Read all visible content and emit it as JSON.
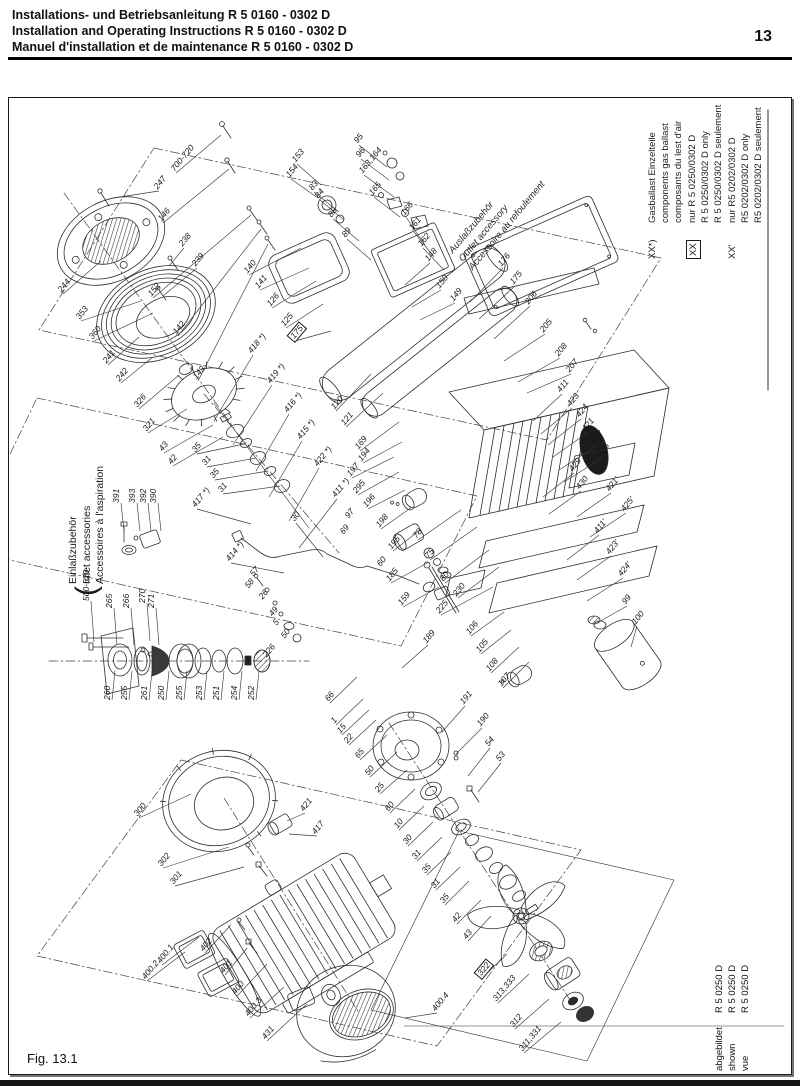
{
  "header": {
    "line1": "Installations- und Betriebsanleitung R 5 0160 - 0302 D",
    "line2": "Installation and Operating Instructions R 5 0160 - 0302 D",
    "line3": "Manuel d'installation et de maintenance R 5 0160 - 0302 D",
    "page_number": "13"
  },
  "figure": {
    "caption": "Fig. 13.1"
  },
  "legend": {
    "blocks": [
      {
        "marker": "XX*)",
        "boxed": false,
        "lines": [
          "Gasballast Einzelteile",
          "components gas ballast",
          "composants du lest d'air"
        ]
      },
      {
        "marker": "XX",
        "boxed": true,
        "lines": [
          "nur R 5 0250/0302 D",
          "R 5 0250/0302 D only",
          "R 5 0250/0302 D  seulement"
        ]
      },
      {
        "marker": "XX'",
        "boxed": false,
        "lines": [
          "nur R5 0202/0302 D",
          "R5 0202/0302 D only",
          "R5 0202/0302 D seulement"
        ]
      }
    ]
  },
  "inlet_label": {
    "bracket": "(",
    "lines": [
      "Einlaßzubehör",
      "Inlet accessories",
      "Accessoires à l'aspiration"
    ]
  },
  "outlet_label": {
    "lines": [
      "Auslaßzubehör",
      "Outlet accessory",
      "Accessoire au refoulement"
    ]
  },
  "shown": {
    "rows": [
      [
        "abgebildet",
        "R 5 0250 D"
      ],
      [
        "shown",
        "R 5 0250 D"
      ],
      [
        "vue",
        "R 5 0250 D"
      ]
    ]
  },
  "colors": {
    "ink": "#1a1a1a",
    "line": "#2e2e2e"
  },
  "callouts": [
    [
      "247",
      158,
      190,
      "d",
      [
        112,
        197
      ],
      0
    ],
    [
      "244",
      62,
      293,
      "d",
      [
        100,
        260
      ],
      0
    ],
    [
      "353",
      80,
      320,
      "d",
      [
        140,
        300
      ],
      0
    ],
    [
      "360",
      93,
      340,
      "d",
      [
        152,
        312
      ],
      0
    ],
    [
      "241",
      107,
      364,
      "d",
      [
        138,
        336
      ],
      0
    ],
    [
      "242",
      120,
      382,
      "d",
      [
        152,
        356
      ],
      0
    ],
    [
      "326",
      138,
      408,
      "d",
      [
        178,
        374
      ],
      0
    ],
    [
      "238",
      183,
      247,
      "d",
      [
        168,
        265
      ],
      0
    ],
    [
      "239",
      196,
      267,
      "d",
      [
        162,
        295
      ],
      0
    ],
    [
      "321",
      147,
      432,
      "d",
      [
        186,
        408
      ],
      0
    ],
    [
      "43",
      163,
      452,
      "d",
      [
        212,
        424
      ],
      0
    ],
    [
      "42",
      172,
      465,
      "d",
      [
        222,
        436
      ],
      0
    ],
    [
      "35",
      196,
      453,
      "d",
      [
        243,
        443
      ],
      0
    ],
    [
      "31",
      206,
      466,
      "d",
      [
        255,
        457
      ],
      0
    ],
    [
      "35",
      214,
      479,
      "d",
      [
        267,
        470
      ],
      0
    ],
    [
      "31",
      222,
      493,
      "d",
      [
        279,
        485
      ],
      0
    ],
    [
      "417 *)",
      196,
      508,
      "d",
      [
        250,
        523
      ],
      0
    ],
    [
      "414 *)",
      230,
      562,
      "d",
      [
        283,
        572
      ],
      0
    ],
    [
      "418 *)",
      252,
      354,
      "d",
      [
        213,
        420
      ],
      0
    ],
    [
      "419 *)",
      271,
      384,
      "d",
      [
        232,
        444
      ],
      0
    ],
    [
      "416 *)",
      288,
      413,
      "d",
      [
        255,
        470
      ],
      0
    ],
    [
      "415 *)",
      301,
      440,
      "d",
      [
        268,
        496
      ],
      0
    ],
    [
      "422 *)",
      318,
      467,
      "d",
      [
        288,
        520
      ],
      0
    ],
    [
      "411 *)",
      336,
      498,
      "d",
      [
        298,
        547
      ],
      0
    ],
    [
      "30",
      295,
      522,
      "d",
      [
        322,
        556
      ],
      0
    ],
    [
      "126",
      271,
      307,
      "d",
      [
        315,
        280
      ],
      0
    ],
    [
      "125",
      285,
      327,
      "d",
      [
        322,
        303
      ],
      0
    ],
    [
      "175",
      294,
      340,
      "d",
      [
        330,
        330
      ],
      1
    ],
    [
      "120",
      335,
      410,
      "d",
      [
        370,
        373
      ],
      0
    ],
    [
      "121",
      345,
      426,
      "d",
      [
        382,
        392
      ],
      0
    ],
    [
      "169",
      359,
      450,
      "d",
      [
        398,
        421
      ],
      0
    ],
    [
      "194",
      362,
      462,
      "d",
      [
        401,
        441
      ],
      0
    ],
    [
      "197",
      351,
      477,
      "d",
      [
        393,
        456
      ],
      0
    ],
    [
      "295",
      357,
      494,
      "d",
      [
        398,
        471
      ],
      0
    ],
    [
      "196",
      367,
      508,
      "d",
      [
        404,
        489
      ],
      0
    ],
    [
      "198",
      380,
      528,
      "d",
      [
        411,
        506
      ],
      0
    ],
    [
      "195",
      392,
      550,
      "d",
      [
        419,
        529
      ],
      0
    ],
    [
      "185",
      390,
      582,
      "d",
      [
        428,
        561
      ],
      0
    ],
    [
      "159",
      402,
      606,
      "d",
      [
        438,
        586
      ],
      0
    ],
    [
      "97",
      349,
      519,
      "d",
      null,
      0
    ],
    [
      "69",
      344,
      535,
      "d",
      null,
      0
    ],
    [
      "60",
      381,
      567,
      "d",
      null,
      0
    ],
    [
      "78",
      417,
      539,
      "d",
      [
        460,
        509
      ],
      0
    ],
    [
      "75",
      429,
      559,
      "d",
      [
        476,
        526
      ],
      0
    ],
    [
      "80",
      444,
      582,
      "d",
      [
        488,
        549
      ],
      0
    ],
    [
      "230",
      457,
      597,
      "d",
      [
        498,
        566
      ],
      0
    ],
    [
      "225",
      440,
      614,
      "d",
      [
        492,
        586
      ],
      0
    ],
    [
      "153",
      296,
      163,
      "d",
      [
        320,
        184
      ],
      0
    ],
    [
      "154",
      290,
      178,
      "d",
      [
        317,
        197
      ],
      0
    ],
    [
      "83",
      313,
      191,
      "d",
      [
        338,
        211
      ],
      0
    ],
    [
      "84",
      319,
      199,
      "d",
      [
        343,
        219
      ],
      0
    ],
    [
      "88",
      332,
      218,
      "d",
      [
        358,
        240
      ],
      0
    ],
    [
      "89",
      346,
      238,
      "d",
      [
        370,
        259
      ],
      0
    ],
    [
      "95",
      358,
      144,
      "d",
      [
        386,
        166
      ],
      0
    ],
    [
      "96",
      360,
      158,
      "d",
      [
        388,
        179
      ],
      0
    ],
    [
      "163,164",
      363,
      174,
      "d",
      [
        393,
        196
      ],
      0
    ],
    [
      "165",
      373,
      196,
      "d",
      [
        399,
        216
      ],
      0
    ],
    [
      "166",
      405,
      216,
      "d",
      [
        424,
        244
      ],
      0
    ],
    [
      "161",
      413,
      231,
      "d",
      [
        433,
        256
      ],
      0
    ],
    [
      "162",
      422,
      247,
      "d",
      [
        443,
        269
      ],
      0
    ],
    [
      "700-720",
      175,
      172,
      "d",
      [
        220,
        134
      ],
      0
    ],
    [
      "146",
      162,
      222,
      "d",
      [
        228,
        168
      ],
      0
    ],
    [
      "152",
      152,
      297,
      "d",
      [
        250,
        214
      ],
      0
    ],
    [
      "142",
      177,
      335,
      "d",
      [
        260,
        228
      ],
      0
    ],
    [
      "143",
      197,
      380,
      "d",
      [
        267,
        243
      ],
      0
    ],
    [
      "140",
      248,
      274,
      "d",
      [
        300,
        247
      ],
      0
    ],
    [
      "141",
      259,
      289,
      "d",
      [
        308,
        267
      ],
      0
    ],
    [
      "148",
      429,
      262,
      "d",
      [
        404,
        284
      ],
      0
    ],
    [
      "150",
      440,
      289,
      "d",
      [
        411,
        306
      ],
      0
    ],
    [
      "149",
      454,
      302,
      "d",
      [
        419,
        319
      ],
      0
    ],
    [
      "176",
      502,
      267,
      "d",
      [
        469,
        301
      ],
      0
    ],
    [
      "175",
      514,
      285,
      "d",
      [
        478,
        318
      ],
      0
    ],
    [
      "206",
      529,
      305,
      "d",
      [
        493,
        338
      ],
      0
    ],
    [
      "205",
      544,
      333,
      "d",
      [
        503,
        360
      ],
      0
    ],
    [
      "208",
      559,
      357,
      "d",
      [
        517,
        381
      ],
      0
    ],
    [
      "207",
      570,
      373,
      "d",
      [
        526,
        392
      ],
      0
    ],
    [
      "106",
      470,
      635,
      "d",
      [
        503,
        611
      ],
      0
    ],
    [
      "105",
      480,
      653,
      "d",
      [
        510,
        629
      ],
      0
    ],
    [
      "108",
      490,
      672,
      "d",
      [
        518,
        646
      ],
      0
    ],
    [
      "107",
      502,
      687,
      "d",
      [
        528,
        661
      ],
      0
    ],
    [
      "99",
      626,
      605,
      "d",
      [
        596,
        622
      ],
      0
    ],
    [
      "100",
      636,
      625,
      "d",
      [
        630,
        646
      ],
      0
    ],
    [
      "411",
      561,
      393,
      "d",
      [
        532,
        420
      ],
      0
    ],
    [
      "423",
      571,
      407,
      "d",
      [
        540,
        433
      ],
      0
    ],
    [
      "424",
      580,
      418,
      "d",
      [
        547,
        444
      ],
      0
    ],
    [
      "421",
      586,
      432,
      "d",
      [
        552,
        456
      ],
      0
    ],
    [
      "427",
      595,
      445,
      "d",
      [
        558,
        469
      ],
      0
    ],
    [
      "425",
      601,
      457,
      "d",
      [
        563,
        481
      ],
      0
    ],
    [
      "429",
      573,
      472,
      "d",
      [
        542,
        496
      ],
      0
    ],
    [
      "430",
      580,
      490,
      "d",
      [
        548,
        513
      ],
      0
    ],
    [
      "421'",
      610,
      492,
      "d",
      [
        576,
        516
      ],
      0
    ],
    [
      "425'",
      625,
      512,
      "d",
      [
        589,
        536
      ],
      0
    ],
    [
      "411'",
      598,
      534,
      "d",
      [
        566,
        559
      ],
      0
    ],
    [
      "423'",
      610,
      555,
      "d",
      [
        576,
        579
      ],
      0
    ],
    [
      "424'",
      622,
      577,
      "d",
      [
        586,
        600
      ],
      0
    ],
    [
      "66",
      329,
      702,
      "d",
      [
        356,
        676
      ],
      0
    ],
    [
      "1",
      335,
      724,
      "d",
      [
        362,
        698
      ],
      0
    ],
    [
      "15",
      341,
      734,
      "d",
      [
        368,
        709
      ],
      0
    ],
    [
      "22",
      348,
      744,
      "d",
      [
        375,
        719
      ],
      0
    ],
    [
      "65",
      359,
      759,
      "d",
      [
        386,
        734
      ],
      0
    ],
    [
      "50",
      369,
      776,
      "d",
      [
        396,
        751
      ],
      0
    ],
    [
      "25",
      379,
      793,
      "d",
      [
        406,
        769
      ],
      0
    ],
    [
      "60",
      389,
      812,
      "d",
      [
        414,
        788
      ],
      0
    ],
    [
      "10",
      398,
      829,
      "d",
      [
        423,
        805
      ],
      0
    ],
    [
      "30",
      407,
      845,
      "d",
      [
        432,
        821
      ],
      0
    ],
    [
      "31",
      416,
      860,
      "d",
      [
        441,
        836
      ],
      0
    ],
    [
      "35",
      426,
      874,
      "d",
      [
        450,
        851
      ],
      0
    ],
    [
      "31",
      435,
      889,
      "d",
      [
        459,
        866
      ],
      0
    ],
    [
      "35",
      444,
      904,
      "d",
      [
        468,
        880
      ],
      0
    ],
    [
      "42",
      456,
      923,
      "d",
      [
        480,
        899
      ],
      0
    ],
    [
      "43",
      467,
      940,
      "d",
      [
        490,
        915
      ],
      0
    ],
    [
      "53",
      500,
      762,
      "d",
      [
        477,
        791
      ],
      0
    ],
    [
      "54",
      489,
      747,
      "d",
      [
        467,
        775
      ],
      0
    ],
    [
      "190",
      481,
      727,
      "d",
      [
        455,
        753
      ],
      0
    ],
    [
      "191",
      464,
      705,
      "d",
      [
        441,
        731
      ],
      0
    ],
    [
      "189",
      427,
      644,
      "d",
      [
        401,
        667
      ],
      0
    ],
    [
      "57",
      254,
      577,
      "d",
      null,
      0
    ],
    [
      "58",
      249,
      589,
      "d",
      null,
      0
    ],
    [
      "26",
      263,
      600,
      "d",
      null,
      0
    ],
    [
      "49",
      273,
      617,
      "d",
      null,
      0
    ],
    [
      "5",
      277,
      626,
      "d",
      null,
      0
    ],
    [
      "50",
      285,
      639,
      "d",
      null,
      0
    ],
    [
      "226",
      267,
      658,
      "d",
      null,
      0
    ],
    [
      "300",
      138,
      817,
      "d",
      [
        190,
        793
      ],
      0
    ],
    [
      "302",
      162,
      867,
      "d",
      [
        228,
        846
      ],
      0
    ],
    [
      "301",
      174,
      885,
      "d",
      [
        243,
        866
      ],
      0
    ],
    [
      "421",
      304,
      812,
      "d",
      [
        286,
        820
      ],
      0
    ],
    [
      "417",
      316,
      835,
      "d",
      [
        288,
        833
      ],
      0
    ],
    [
      "400.2",
      146,
      980,
      "d",
      [
        184,
        951
      ],
      0
    ],
    [
      "400.1",
      161,
      964,
      "d",
      [
        198,
        936
      ],
      0
    ],
    [
      "402",
      204,
      952,
      "d",
      [
        230,
        924
      ],
      0
    ],
    [
      "401",
      224,
      974,
      "d",
      [
        246,
        947
      ],
      0
    ],
    [
      "400",
      236,
      995,
      "d",
      [
        266,
        963
      ],
      0
    ],
    [
      "400.3",
      249,
      1017,
      "d",
      [
        283,
        986
      ],
      0
    ],
    [
      "431",
      266,
      1040,
      "d",
      [
        306,
        1003
      ],
      0
    ],
    [
      "400.4",
      436,
      1012,
      "d",
      [
        404,
        1017
      ],
      0
    ],
    [
      "322",
      481,
      977,
      "d",
      [
        506,
        953
      ],
      1
    ],
    [
      "313,333",
      497,
      1002,
      "d",
      [
        528,
        973
      ],
      0
    ],
    [
      "312",
      514,
      1028,
      "d",
      [
        548,
        998
      ],
      0
    ],
    [
      "311,331",
      523,
      1052,
      "d",
      [
        560,
        1021
      ],
      0
    ],
    [
      "391",
      120,
      502,
      "v",
      [
        123,
        530
      ],
      0
    ],
    [
      "393",
      136,
      502,
      "v",
      [
        139,
        530
      ],
      0
    ],
    [
      "392",
      147,
      502,
      "v",
      [
        150,
        530
      ],
      0
    ],
    [
      "390",
      157,
      502,
      "v",
      [
        160,
        530
      ],
      0
    ],
    [
      "500-520",
      90,
      600,
      "v",
      [
        93,
        641
      ],
      0
    ],
    [
      "265",
      113,
      607,
      "v",
      [
        116,
        644
      ],
      0
    ],
    [
      "266",
      130,
      607,
      "v",
      [
        133,
        644
      ],
      0
    ],
    [
      "270",
      146,
      602,
      "v",
      [
        149,
        640
      ],
      0
    ],
    [
      "271",
      155,
      607,
      "v",
      [
        158,
        644
      ],
      0
    ],
    [
      "260",
      111,
      699,
      "v",
      [
        114,
        670
      ],
      0
    ],
    [
      "255",
      128,
      699,
      "v",
      [
        131,
        670
      ],
      0
    ],
    [
      "261",
      148,
      699,
      "v",
      [
        151,
        670
      ],
      0
    ],
    [
      "250",
      165,
      699,
      "v",
      [
        168,
        670
      ],
      0
    ],
    [
      "255",
      183,
      699,
      "v",
      [
        186,
        670
      ],
      0
    ],
    [
      "253",
      203,
      699,
      "v",
      [
        206,
        670
      ],
      0
    ],
    [
      "251",
      220,
      699,
      "v",
      [
        223,
        670
      ],
      0
    ],
    [
      "254",
      238,
      699,
      "v",
      [
        241,
        670
      ],
      0
    ],
    [
      "252",
      255,
      699,
      "v",
      [
        258,
        670
      ],
      0
    ]
  ]
}
